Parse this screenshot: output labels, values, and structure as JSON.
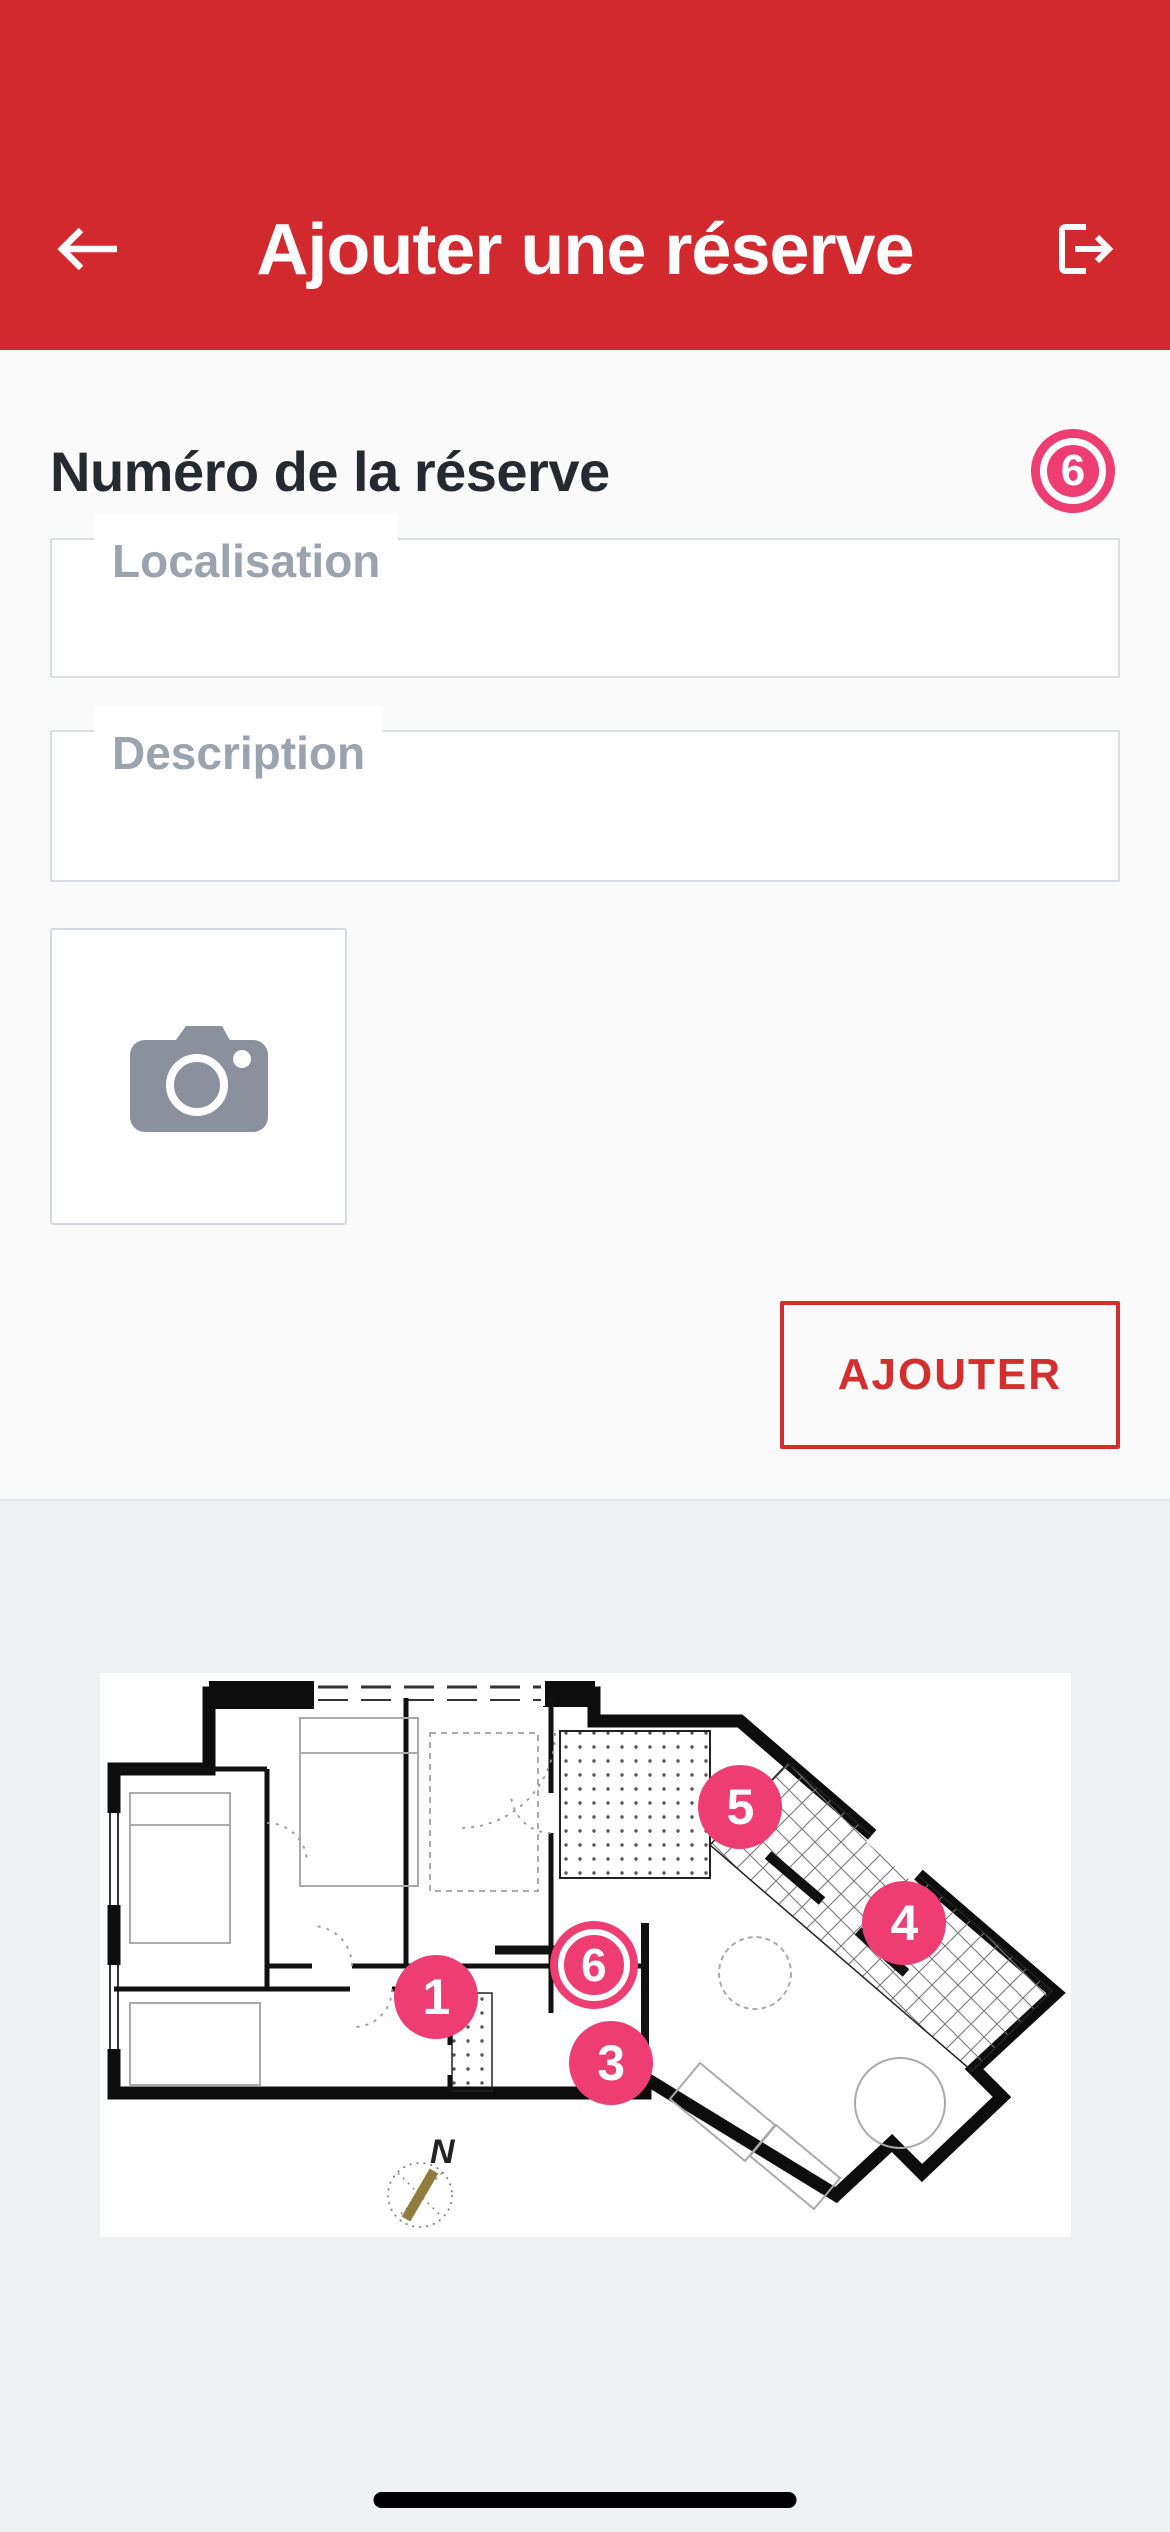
{
  "colors": {
    "header_red": "#d2292f",
    "submit_red": "#d32f2f",
    "accent_pink": "#ee3d72",
    "page_bg": "#fafafb",
    "footer_bg": "#eff0f2",
    "field_border": "#d9dce1",
    "label_gray": "#9aa3ae",
    "heading_dark": "#252a31",
    "camera_gray": "#8a919c",
    "compass_needle": "#8f7c3e",
    "wall_black": "#0d0d0d"
  },
  "header": {
    "title": "Ajouter une réserve",
    "back_icon": "back-arrow-icon",
    "logout_icon": "logout-icon"
  },
  "form": {
    "heading": "Numéro de la réserve",
    "badge_value": "6",
    "fields": [
      {
        "label": "Localisation",
        "value": ""
      },
      {
        "label": "Description",
        "value": ""
      }
    ],
    "photo_icon": "camera-icon",
    "submit_label": "AJOUTER"
  },
  "plan": {
    "compass_label": "N",
    "markers": [
      {
        "label": "1",
        "x_pct": 34.7,
        "y_pct": 57.4,
        "selected": false
      },
      {
        "label": "3",
        "x_pct": 52.7,
        "y_pct": 69.1,
        "selected": false
      },
      {
        "label": "6",
        "x_pct": 50.9,
        "y_pct": 51.8,
        "selected": true
      },
      {
        "label": "5",
        "x_pct": 66.0,
        "y_pct": 23.8,
        "selected": false
      },
      {
        "label": "4",
        "x_pct": 82.9,
        "y_pct": 44.3,
        "selected": false
      }
    ]
  }
}
